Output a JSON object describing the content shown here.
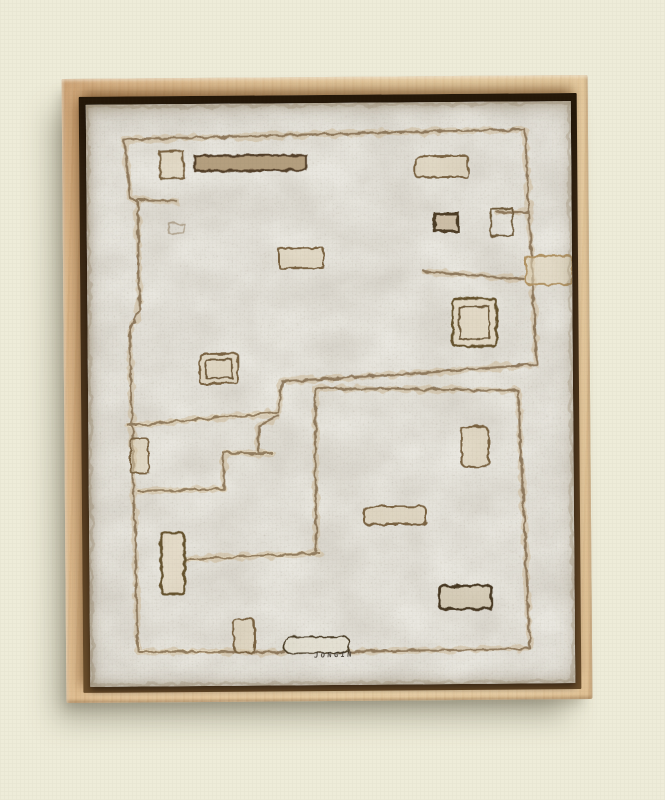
{
  "scene": {
    "description": "Framed abstract relief painting (white textured surface with incised geometric grooves) hanging on a gallery wall",
    "artwork": {
      "signature": "JONGIN",
      "style": "monochrome white relief with carved rectangles and maze-like incised lines",
      "frame": "natural light-wood floater frame"
    }
  },
  "palette": {
    "wall_warm": "#f1efde",
    "wall_cool": "#ecf4f6",
    "wall_shadow": "#e3dfc9",
    "frame_wood_light": "#e9cfa4",
    "frame_wood": "#ddb687",
    "frame_wood_dark": "#c99e70",
    "floater_gap": "#3d2a15",
    "canvas_base": "#e9e7e0",
    "groove_brown": "#846d4f",
    "groove_dark": "#53402a",
    "groove_tan": "#c9b28c",
    "groove_highlight": "#f0e4c9",
    "signature_ink": "#3a332a"
  }
}
